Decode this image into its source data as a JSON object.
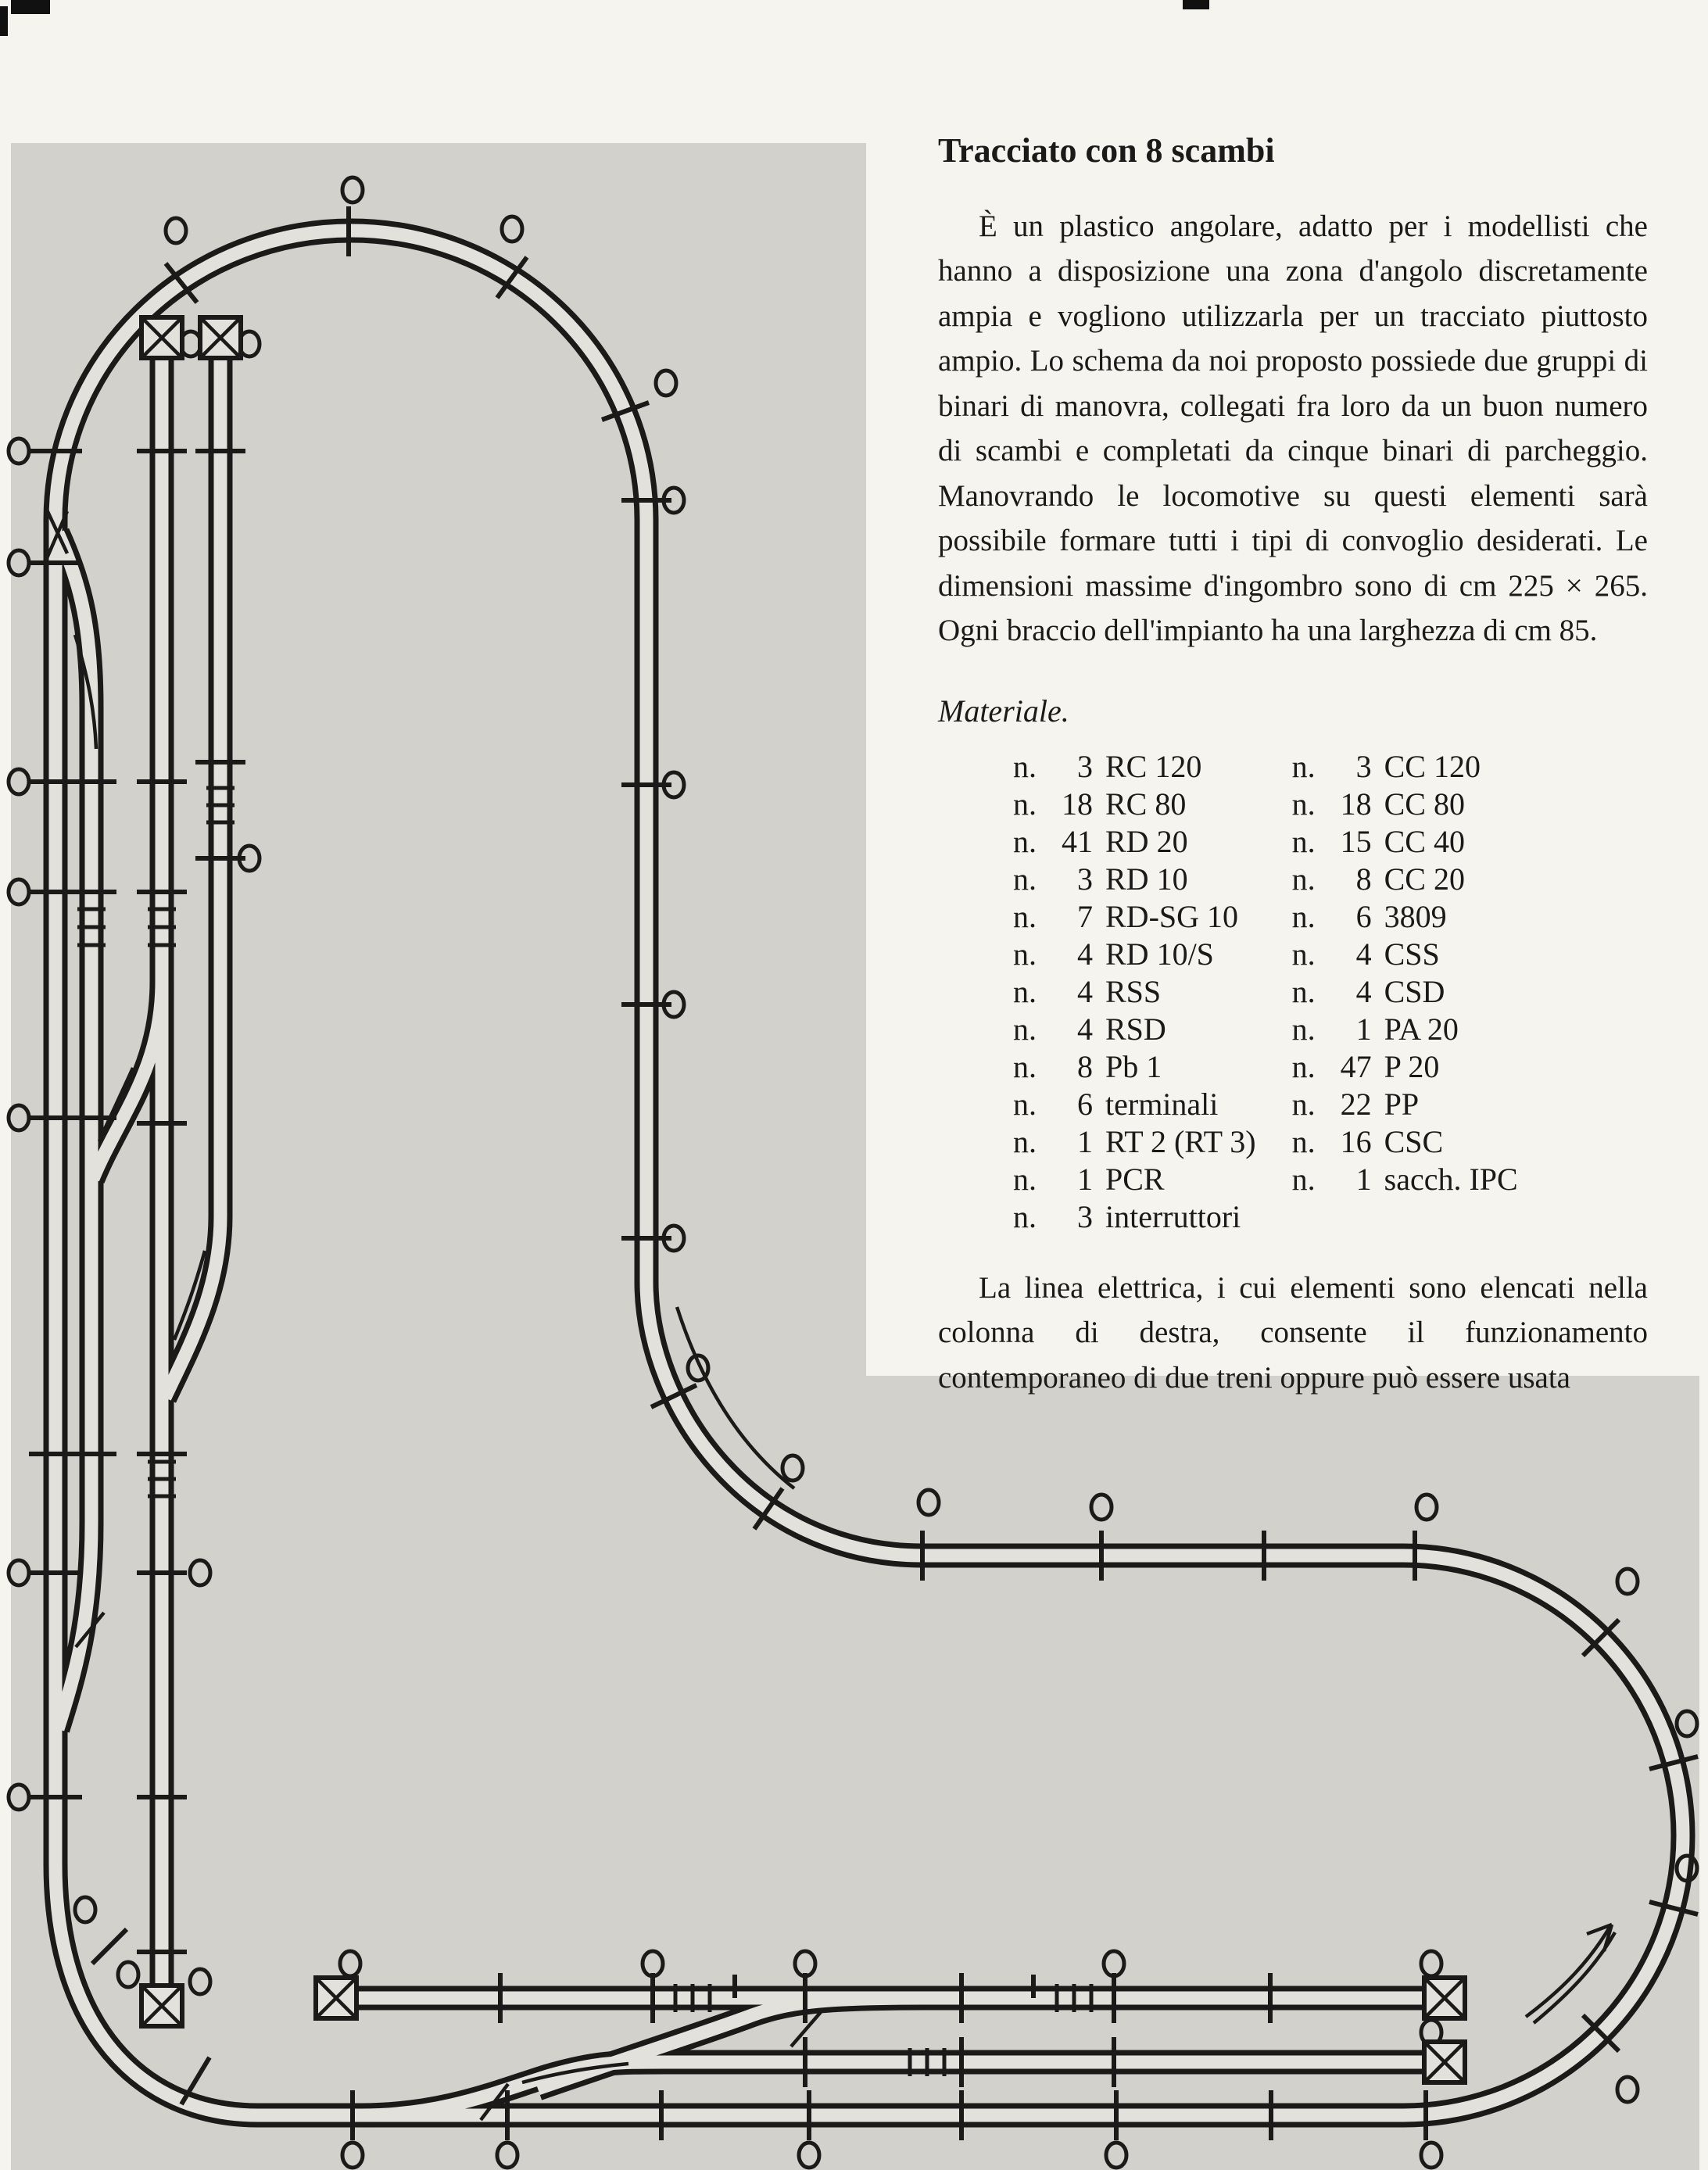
{
  "colors": {
    "page_bg": "#f6f4ee",
    "diagram_bg": "#d2d1cc",
    "track_band": "#e2e1dc",
    "ink": "#1b1a18"
  },
  "article": {
    "title": "Tracciato con 8 scambi",
    "para1": "È un plastico angolare, adatto per i modellisti che hanno a disposizione una zona d'angolo discretamente ampia e vogliono utilizzarla per un tracciato piuttosto ampio. Lo schema da noi proposto possiede due gruppi di binari di manovra, collegati fra loro da un buon numero di scambi e completati da cinque binari di parcheggio. Manovrando le locomotive su questi elementi sarà possibile formare tutti i tipi di convoglio desiderati. Le dimensioni massime d'ingombro sono di cm 225 × 265. Ogni braccio dell'impianto ha una larghezza di cm 85.",
    "materials_heading": "Materiale.",
    "n_prefix": "n.",
    "materials_left": [
      {
        "num": "3",
        "code": "RC 120"
      },
      {
        "num": "18",
        "code": "RC 80"
      },
      {
        "num": "41",
        "code": "RD 20"
      },
      {
        "num": "3",
        "code": "RD 10"
      },
      {
        "num": "7",
        "code": "RD-SG 10"
      },
      {
        "num": "4",
        "code": "RD 10/S"
      },
      {
        "num": "4",
        "code": "RSS"
      },
      {
        "num": "4",
        "code": "RSD"
      },
      {
        "num": "8",
        "code": "Pb 1"
      },
      {
        "num": "6",
        "code": "terminali"
      },
      {
        "num": "1",
        "code": "RT 2 (RT 3)"
      },
      {
        "num": "1",
        "code": "PCR"
      },
      {
        "num": "3",
        "code": "interruttori"
      }
    ],
    "materials_right": [
      {
        "num": "3",
        "code": "CC 120"
      },
      {
        "num": "18",
        "code": "CC 80"
      },
      {
        "num": "15",
        "code": "CC 40"
      },
      {
        "num": "8",
        "code": "CC 20"
      },
      {
        "num": "6",
        "code": "3809"
      },
      {
        "num": "4",
        "code": "CSS"
      },
      {
        "num": "4",
        "code": "CSD"
      },
      {
        "num": "1",
        "code": "PA 20"
      },
      {
        "num": "47",
        "code": "P 20"
      },
      {
        "num": "22",
        "code": "PP"
      },
      {
        "num": "16",
        "code": "CSC"
      },
      {
        "num": "1",
        "code": "sacch. IPC"
      }
    ],
    "para2": "La linea elettrica, i cui elementi sono elencati nella colonna di destra, consente il funzionamento contemporaneo di due treni oppure può essere usata"
  }
}
